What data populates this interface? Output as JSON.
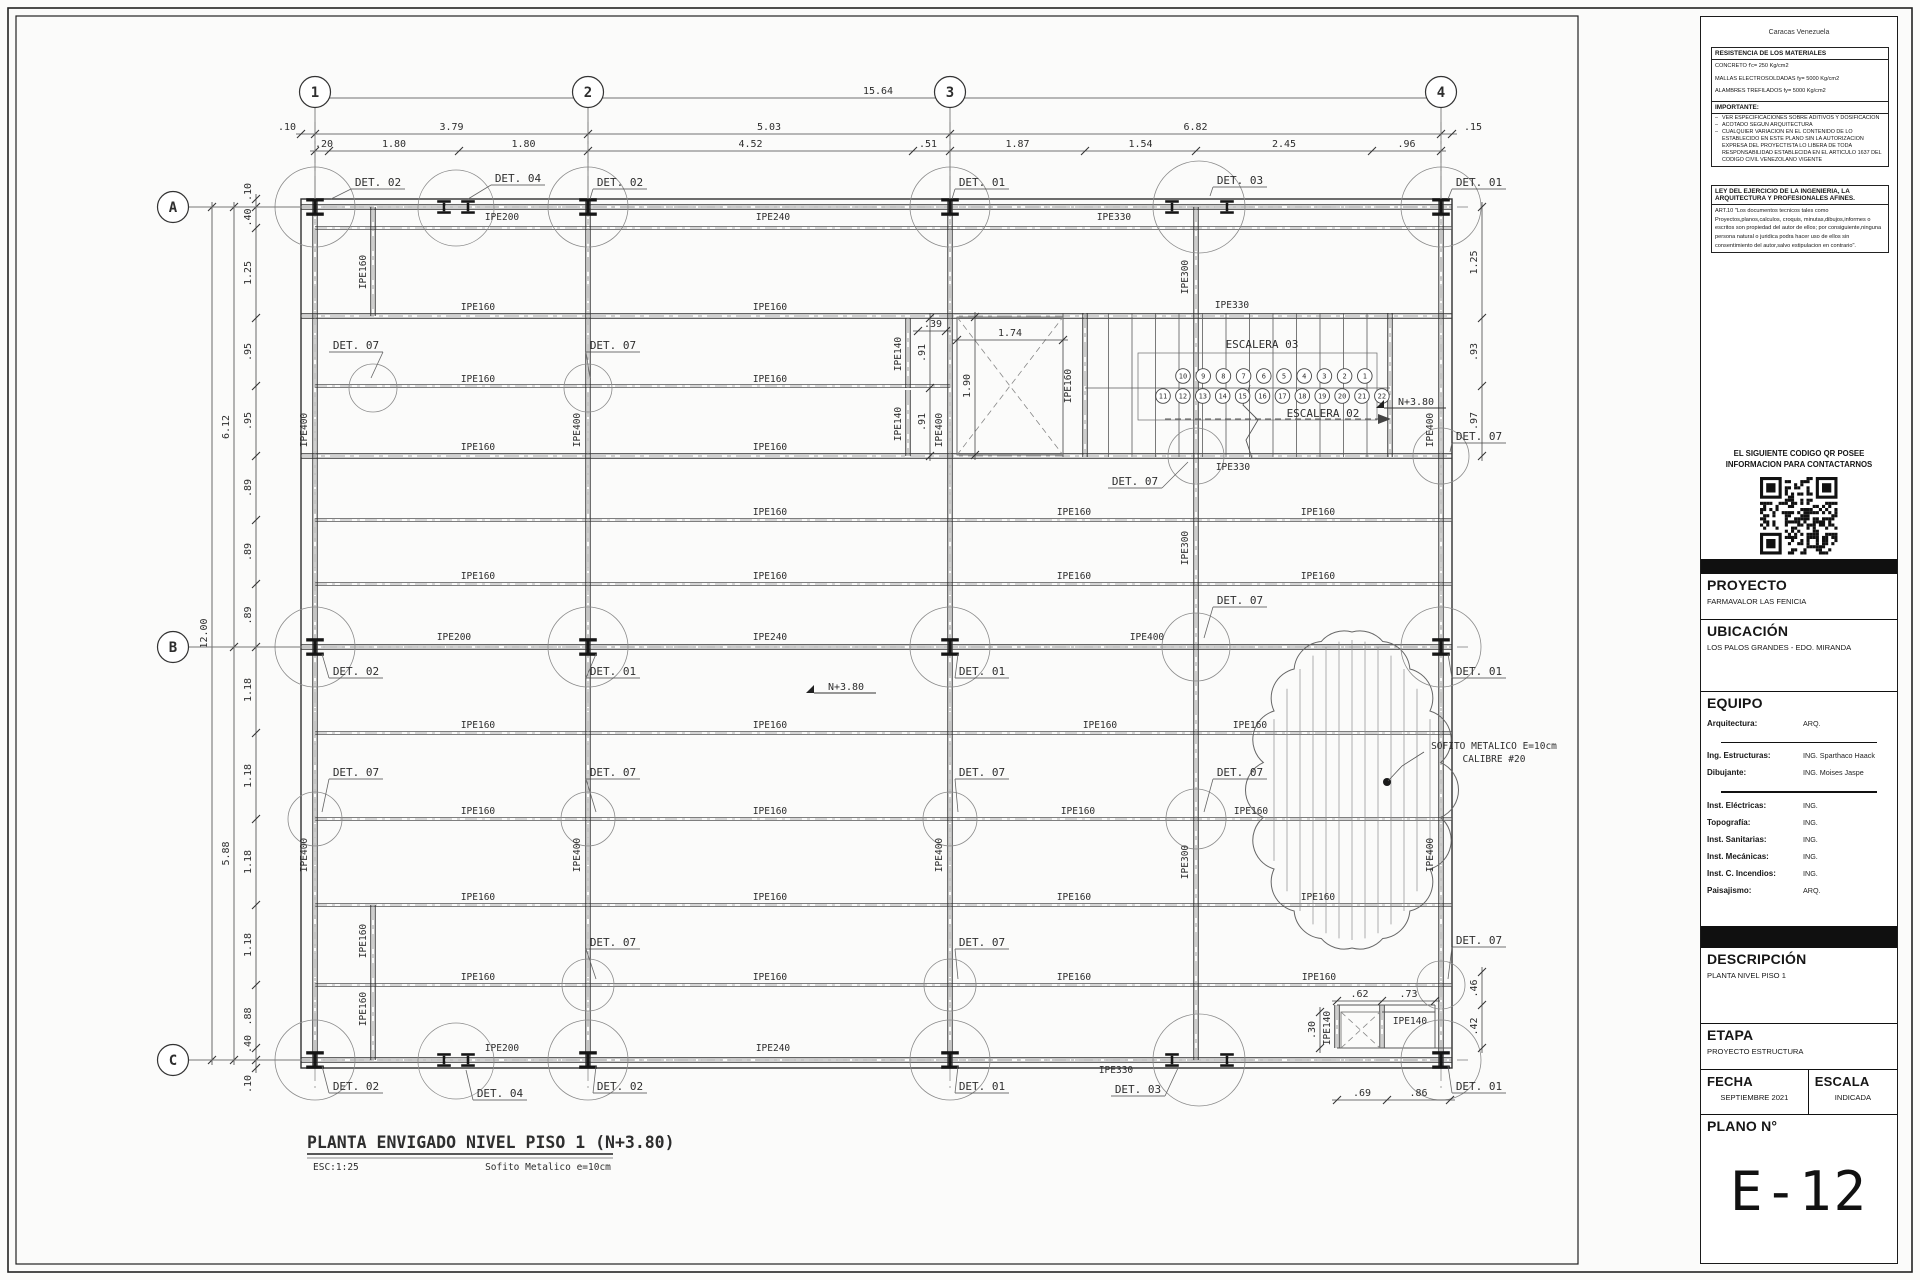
{
  "tb": {
    "city": "Caracas Venezuela",
    "materials": {
      "title": "RESISTENCIA DE LOS MATERIALES",
      "lines": [
        "CONCRETO f'c= 250 Kg/cm2",
        "MALLAS ELECTROSOLDADAS fy= 5000 Kg/cm2",
        "ALAMBRES TREFILADOS fy= 5000 Kg/cm2",
        "CABILLAS fy= 4200 Kg/cm2",
        "ACERO, PERFILES Y PLANCHAS fy= 2530 Kg/cm2"
      ]
    },
    "importante": {
      "title": "IMPORTANTE:",
      "bullets": [
        "VER ESPECIFICACIONES SOBRE ADITIVOS Y DOSIFICACION",
        "ACOTADO SEGUN ARQUITECTURA",
        "CUALQUIER VARIACION EN EL CONTENIDO DE LO ESTABLECIDO EN ESTE PLANO SIN LA AUTORIZACION EXPRESA DEL PROYECTISTA LO LIBERA DE TODA RESPONSABILIDAD ESTABLECIDA EN EL ARTICULO 1637 DEL CODIGO CIVIL VENEZOLANO VIGENTE"
      ]
    },
    "ley": {
      "title": "LEY DEL EJERCICIO DE LA INGENIERIA, LA ARQUITECTURA Y PROFESIONALES AFINES.",
      "body": "ART.10 \"Los documentos tecnicos tales como Proyectos,planos,calculos, croquis, minutas,dibujos,informes o escritos son propiedad del autor de ellos; por consiguiente,ninguna persona natural o juridica podra hacer uso de ellos sin consentimiento del autor,salvo estipulacion en contrario\"."
    },
    "qr_caption_1": "EL SIGUIENTE CODIGO QR POSEE",
    "qr_caption_2": "INFORMACION PARA CONTACTARNOS",
    "proyecto": {
      "label": "PROYECTO",
      "value": "FARMAVALOR LAS FENICIA"
    },
    "ubicacion": {
      "label": "UBICACIÓN",
      "value": "LOS PALOS GRANDES - EDO. MIRANDA"
    },
    "equipo": {
      "label": "EQUIPO",
      "rows": [
        {
          "k": "Arquitectura:",
          "v": "ARQ."
        },
        {
          "k": "Ing. Estructuras:",
          "v": "ING. Sparthaco Haack"
        },
        {
          "k": "Dibujante:",
          "v": "ING. Moises Jaspe"
        },
        {
          "k": "Inst. Eléctricas:",
          "v": "ING."
        },
        {
          "k": "Topografía:",
          "v": "ING."
        },
        {
          "k": "Inst. Sanitarias:",
          "v": "ING."
        },
        {
          "k": "Inst. Mecánicas:",
          "v": "ING."
        },
        {
          "k": "Inst. C. Incendios:",
          "v": "ING."
        },
        {
          "k": "Paisajismo:",
          "v": "ARQ."
        }
      ]
    },
    "descripcion": {
      "label": "DESCRIPCIÓN",
      "value": "PLANTA NIVEL PISO 1"
    },
    "etapa": {
      "label": "ETAPA",
      "value": "PROYECTO ESTRUCTURA"
    },
    "fecha": {
      "label": "FECHA",
      "value": "SEPTIEMBRE  2021"
    },
    "escala": {
      "label": "ESCALA",
      "value": "INDICADA"
    },
    "plano": {
      "label": "PLANO N°",
      "value": "E-12"
    }
  },
  "plan": {
    "title": {
      "main": "PLANTA ENVIGADO NIVEL PISO 1 (N+3.80)",
      "scale": "ESC:1:25",
      "note": "Sofito  Metalico  e=10cm"
    },
    "grid": {
      "cols": [
        {
          "id": "1",
          "x": 315
        },
        {
          "id": "2",
          "x": 588
        },
        {
          "id": "3",
          "x": 950
        },
        {
          "id": "4",
          "x": 1441
        }
      ],
      "rows": [
        {
          "id": "A",
          "y": 207
        },
        {
          "id": "B",
          "y": 647
        },
        {
          "id": "C",
          "y": 1060
        }
      ]
    },
    "beam_labels": [
      {
        "t": "IPE200",
        "x": 502,
        "y": 220
      },
      {
        "t": "IPE240",
        "x": 773,
        "y": 220
      },
      {
        "t": "IPE330",
        "x": 1114,
        "y": 220
      },
      {
        "t": "IPE160",
        "x": 478,
        "y": 310
      },
      {
        "t": "IPE160",
        "x": 770,
        "y": 310
      },
      {
        "t": "IPE330",
        "x": 1232,
        "y": 308
      },
      {
        "t": "IPE160",
        "x": 478,
        "y": 382
      },
      {
        "t": "IPE160",
        "x": 770,
        "y": 382
      },
      {
        "t": "IPE160",
        "x": 478,
        "y": 450
      },
      {
        "t": "IPE160",
        "x": 770,
        "y": 450
      },
      {
        "t": "IPE330",
        "x": 1233,
        "y": 470
      },
      {
        "t": "IPE160",
        "x": 770,
        "y": 515
      },
      {
        "t": "IPE160",
        "x": 1074,
        "y": 515
      },
      {
        "t": "IPE160",
        "x": 1318,
        "y": 515
      },
      {
        "t": "IPE160",
        "x": 478,
        "y": 579
      },
      {
        "t": "IPE160",
        "x": 770,
        "y": 579
      },
      {
        "t": "IPE160",
        "x": 1074,
        "y": 579
      },
      {
        "t": "IPE160",
        "x": 1318,
        "y": 579
      },
      {
        "t": "IPE200",
        "x": 454,
        "y": 640
      },
      {
        "t": "IPE240",
        "x": 770,
        "y": 640
      },
      {
        "t": "IPE400",
        "x": 1147,
        "y": 640
      },
      {
        "t": "IPE160",
        "x": 478,
        "y": 728
      },
      {
        "t": "IPE160",
        "x": 770,
        "y": 728
      },
      {
        "t": "IPE160",
        "x": 1100,
        "y": 728
      },
      {
        "t": "IPE160",
        "x": 1250,
        "y": 728
      },
      {
        "t": "IPE160",
        "x": 478,
        "y": 814
      },
      {
        "t": "IPE160",
        "x": 770,
        "y": 814
      },
      {
        "t": "IPE160",
        "x": 1078,
        "y": 814
      },
      {
        "t": "IPE160",
        "x": 1251,
        "y": 814
      },
      {
        "t": "IPE160",
        "x": 478,
        "y": 900
      },
      {
        "t": "IPE160",
        "x": 770,
        "y": 900
      },
      {
        "t": "IPE160",
        "x": 1074,
        "y": 900
      },
      {
        "t": "IPE160",
        "x": 1318,
        "y": 900
      },
      {
        "t": "IPE160",
        "x": 478,
        "y": 980
      },
      {
        "t": "IPE160",
        "x": 770,
        "y": 980
      },
      {
        "t": "IPE160",
        "x": 1074,
        "y": 980
      },
      {
        "t": "IPE160",
        "x": 1319,
        "y": 980
      },
      {
        "t": "IPE200",
        "x": 502,
        "y": 1051
      },
      {
        "t": "IPE240",
        "x": 773,
        "y": 1051
      },
      {
        "t": "IPE330",
        "x": 1116,
        "y": 1073
      },
      {
        "t": "IPE140",
        "x": 1410,
        "y": 1024
      },
      {
        "t": "IPE160",
        "x": 366,
        "y": 272,
        "r": 1
      },
      {
        "t": "IPE400",
        "x": 307,
        "y": 430,
        "r": 1
      },
      {
        "t": "IPE400",
        "x": 580,
        "y": 430,
        "r": 1
      },
      {
        "t": "IPE400",
        "x": 942,
        "y": 430,
        "r": 1
      },
      {
        "t": "IPE400",
        "x": 1433,
        "y": 430,
        "r": 1
      },
      {
        "t": "IPE400",
        "x": 307,
        "y": 855,
        "r": 1
      },
      {
        "t": "IPE400",
        "x": 580,
        "y": 855,
        "r": 1
      },
      {
        "t": "IPE400",
        "x": 942,
        "y": 855,
        "r": 1
      },
      {
        "t": "IPE400",
        "x": 1433,
        "y": 855,
        "r": 1
      },
      {
        "t": "IPE300",
        "x": 1188,
        "y": 277,
        "r": 1
      },
      {
        "t": "IPE300",
        "x": 1188,
        "y": 548,
        "r": 1
      },
      {
        "t": "IPE300",
        "x": 1188,
        "y": 862,
        "r": 1
      },
      {
        "t": "IPE160",
        "x": 366,
        "y": 941,
        "r": 1
      },
      {
        "t": "IPE160",
        "x": 366,
        "y": 1009,
        "r": 1
      },
      {
        "t": "IPE160",
        "x": 1071,
        "y": 386,
        "r": 1
      },
      {
        "t": "IPE140",
        "x": 901,
        "y": 354,
        "r": 1
      },
      {
        "t": "IPE140",
        "x": 901,
        "y": 424,
        "r": 1
      },
      {
        "t": "IPE140",
        "x": 1330,
        "y": 1028,
        "r": 1
      }
    ],
    "detail_labels": [
      {
        "t": "DET. 02",
        "x": 378,
        "y": 186,
        "tx": 331,
        "ty": 199
      },
      {
        "t": "DET. 04",
        "x": 518,
        "y": 182,
        "tx": 468,
        "ty": 199
      },
      {
        "t": "DET. 02",
        "x": 620,
        "y": 186,
        "tx": 590,
        "ty": 199
      },
      {
        "t": "DET. 01",
        "x": 982,
        "y": 186,
        "tx": 952,
        "ty": 199
      },
      {
        "t": "DET. 03",
        "x": 1240,
        "y": 184,
        "tx": 1210,
        "ty": 196
      },
      {
        "t": "DET. 01",
        "x": 1479,
        "y": 186,
        "tx": 1448,
        "ty": 199
      },
      {
        "t": "DET. 07",
        "x": 356,
        "y": 349,
        "tx": 371,
        "ty": 378
      },
      {
        "t": "DET. 07",
        "x": 613,
        "y": 349,
        "tx": 590,
        "ty": 378
      },
      {
        "t": "DET. 07",
        "x": 1479,
        "y": 440,
        "tx": 1450,
        "ty": 452
      },
      {
        "t": "DET. 07",
        "x": 1135,
        "y": 485,
        "tx": 1188,
        "ty": 462
      },
      {
        "t": "DET. 02",
        "x": 356,
        "y": 675,
        "tx": 322,
        "ty": 654
      },
      {
        "t": "DET. 01",
        "x": 613,
        "y": 675,
        "tx": 596,
        "ty": 654
      },
      {
        "t": "DET. 01",
        "x": 982,
        "y": 675,
        "tx": 958,
        "ty": 654
      },
      {
        "t": "DET. 01",
        "x": 1479,
        "y": 675,
        "tx": 1448,
        "ty": 654
      },
      {
        "t": "DET. 07",
        "x": 1240,
        "y": 604,
        "tx": 1204,
        "ty": 638
      },
      {
        "t": "DET. 07",
        "x": 356,
        "y": 776,
        "tx": 322,
        "ty": 812
      },
      {
        "t": "DET. 07",
        "x": 613,
        "y": 776,
        "tx": 596,
        "ty": 812
      },
      {
        "t": "DET. 07",
        "x": 982,
        "y": 776,
        "tx": 958,
        "ty": 812
      },
      {
        "t": "DET. 07",
        "x": 1240,
        "y": 776,
        "tx": 1204,
        "ty": 812
      },
      {
        "t": "DET. 07",
        "x": 613,
        "y": 946,
        "tx": 596,
        "ty": 979
      },
      {
        "t": "DET. 07",
        "x": 982,
        "y": 946,
        "tx": 958,
        "ty": 979
      },
      {
        "t": "DET. 07",
        "x": 1479,
        "y": 944,
        "tx": 1448,
        "ty": 979
      },
      {
        "t": "DET. 02",
        "x": 356,
        "y": 1090,
        "tx": 322,
        "ty": 1066
      },
      {
        "t": "DET. 04",
        "x": 500,
        "y": 1097,
        "tx": 466,
        "ty": 1070
      },
      {
        "t": "DET. 02",
        "x": 620,
        "y": 1090,
        "tx": 596,
        "ty": 1066
      },
      {
        "t": "DET. 01",
        "x": 982,
        "y": 1090,
        "tx": 958,
        "ty": 1066
      },
      {
        "t": "DET. 03",
        "x": 1138,
        "y": 1093,
        "tx": 1178,
        "ty": 1068
      },
      {
        "t": "DET. 01",
        "x": 1479,
        "y": 1090,
        "tx": 1448,
        "ty": 1066
      }
    ],
    "dim_chains": [
      {
        "d": "h",
        "p": 98,
        "segs": [
          {
            "a": 315,
            "b": 1441,
            "t": "15.64"
          }
        ]
      },
      {
        "d": "h",
        "p": 134,
        "segs": [
          {
            "a": 301,
            "b": 315,
            "t": ".10",
            "lx": 287
          },
          {
            "a": 315,
            "b": 588,
            "t": "3.79"
          },
          {
            "a": 588,
            "b": 950,
            "t": "5.03"
          },
          {
            "a": 950,
            "b": 1441,
            "t": "6.82"
          },
          {
            "a": 1441,
            "b": 1452,
            "t": ".15",
            "lx": 1473
          }
        ]
      },
      {
        "d": "h",
        "p": 151,
        "segs": [
          {
            "a": 315,
            "b": 329,
            "t": ".20",
            "lx": 324
          },
          {
            "a": 329,
            "b": 459,
            "t": "1.80"
          },
          {
            "a": 459,
            "b": 588,
            "t": "1.80"
          },
          {
            "a": 588,
            "b": 913,
            "t": "4.52"
          },
          {
            "a": 913,
            "b": 950,
            "t": ".51",
            "lx": 928
          },
          {
            "a": 950,
            "b": 1085,
            "t": "1.87"
          },
          {
            "a": 1085,
            "b": 1196,
            "t": "1.54"
          },
          {
            "a": 1196,
            "b": 1372,
            "t": "2.45"
          },
          {
            "a": 1372,
            "b": 1441,
            "t": ".96"
          }
        ]
      },
      {
        "d": "v",
        "p": 212,
        "segs": [
          {
            "a": 207,
            "b": 1060,
            "t": "12.00"
          }
        ]
      },
      {
        "d": "v",
        "p": 234,
        "segs": [
          {
            "a": 207,
            "b": 647,
            "t": "6.12"
          },
          {
            "a": 647,
            "b": 1060,
            "t": "5.88"
          }
        ]
      },
      {
        "d": "v",
        "p": 256,
        "segs": [
          {
            "a": 199,
            "b": 207,
            "t": ".10",
            "ly": 192
          },
          {
            "a": 207,
            "b": 228,
            "t": ".40"
          },
          {
            "a": 228,
            "b": 318,
            "t": "1.25"
          },
          {
            "a": 318,
            "b": 386,
            "t": ".95"
          },
          {
            "a": 386,
            "b": 456,
            "t": ".95"
          },
          {
            "a": 456,
            "b": 520,
            "t": ".89"
          },
          {
            "a": 520,
            "b": 584,
            "t": ".89"
          },
          {
            "a": 584,
            "b": 647,
            "t": ".89"
          },
          {
            "a": 647,
            "b": 733,
            "t": "1.18"
          },
          {
            "a": 733,
            "b": 819,
            "t": "1.18"
          },
          {
            "a": 819,
            "b": 905,
            "t": "1.18"
          },
          {
            "a": 905,
            "b": 985,
            "t": "1.18"
          },
          {
            "a": 985,
            "b": 1048,
            "t": ".88"
          },
          {
            "a": 1048,
            "b": 1060,
            "t": ".40",
            "ly": 1044
          },
          {
            "a": 1060,
            "b": 1068,
            "t": ".10",
            "ly": 1084
          }
        ]
      },
      {
        "d": "v",
        "p": 1482,
        "segs": [
          {
            "a": 207,
            "b": 318,
            "t": "1.25"
          },
          {
            "a": 318,
            "b": 386,
            "t": ".93"
          },
          {
            "a": 386,
            "b": 456,
            "t": ".97"
          }
        ]
      },
      {
        "d": "v",
        "p": 1482,
        "segs": [
          {
            "a": 972,
            "b": 1005,
            "t": ".46"
          },
          {
            "a": 1005,
            "b": 1048,
            "t": ".42"
          }
        ]
      },
      {
        "d": "h",
        "p": 340,
        "segs": [
          {
            "a": 957,
            "b": 1063,
            "t": "1.74"
          }
        ]
      },
      {
        "d": "h",
        "p": 331,
        "segs": [
          {
            "a": 918,
            "b": 946,
            "t": ".39",
            "lx": 933,
            "ly": 327
          }
        ]
      },
      {
        "d": "v",
        "p": 975,
        "segs": [
          {
            "a": 317,
            "b": 455,
            "t": "1.90"
          }
        ]
      },
      {
        "d": "v",
        "p": 930,
        "segs": [
          {
            "a": 318,
            "b": 388,
            "t": ".91"
          },
          {
            "a": 388,
            "b": 456,
            "t": ".91"
          }
        ]
      },
      {
        "d": "h",
        "p": 1001,
        "segs": [
          {
            "a": 1337,
            "b": 1382,
            "t": ".62"
          },
          {
            "a": 1382,
            "b": 1435,
            "t": ".73"
          }
        ]
      },
      {
        "d": "v",
        "p": 1320,
        "segs": [
          {
            "a": 1012,
            "b": 1048,
            "t": ".30"
          }
        ]
      },
      {
        "d": "h",
        "p": 1100,
        "segs": [
          {
            "a": 1337,
            "b": 1387,
            "t": ".69"
          },
          {
            "a": 1387,
            "b": 1450,
            "t": ".86"
          }
        ]
      }
    ],
    "stairs": {
      "label_top": "ESCALERA 03",
      "label_bottom": "ESCALERA 02",
      "row1": [
        "10",
        "9",
        "8",
        "7",
        "6",
        "5",
        "4",
        "3",
        "2",
        "1"
      ],
      "row2": [
        "11",
        "12",
        "13",
        "14",
        "15",
        "16",
        "17",
        "18",
        "19",
        "20",
        "21",
        "22"
      ]
    },
    "levels": [
      {
        "t": "N+3.80",
        "x": 846,
        "y": 690
      },
      {
        "t": "N+3.80",
        "x": 1416,
        "y": 405
      }
    ],
    "cloud_note_1": "SOFITO  METALICO  E=10cm",
    "cloud_note_2": "CALIBRE  #20"
  }
}
